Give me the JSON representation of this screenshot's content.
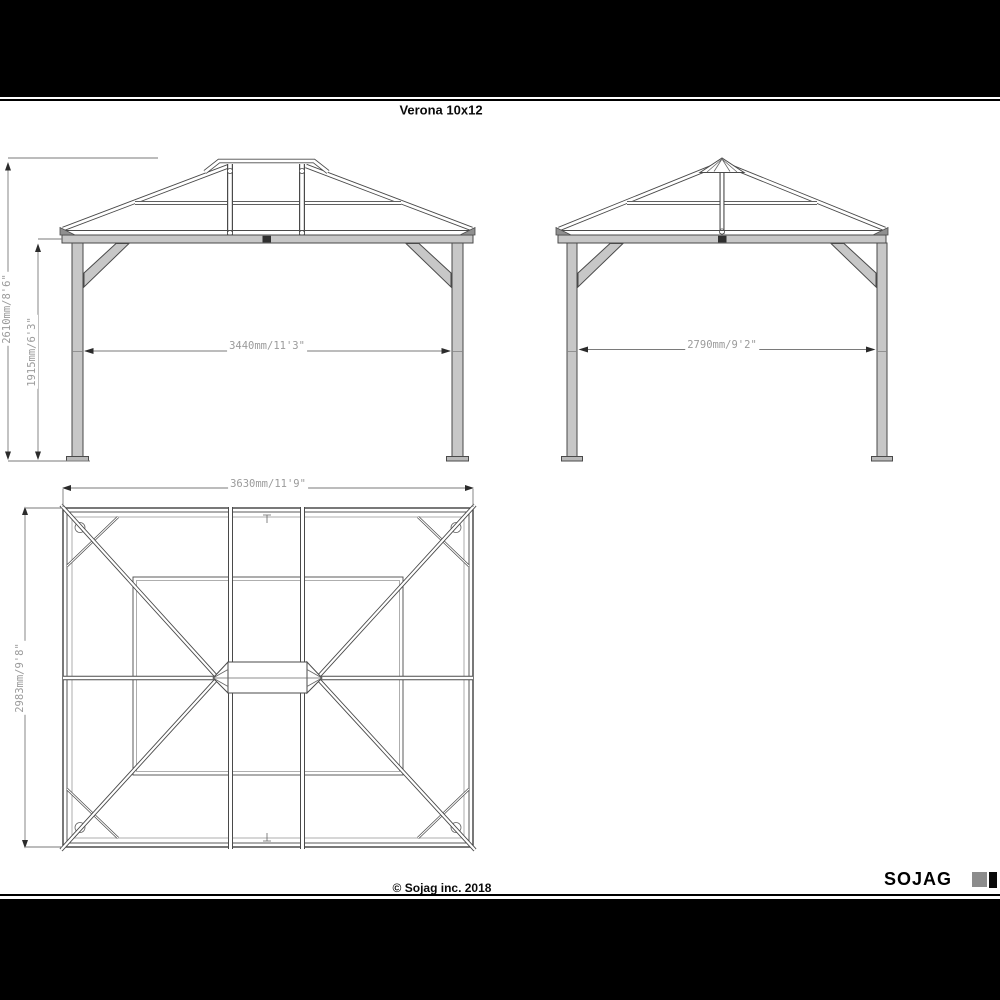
{
  "page": {
    "title": "Verona 10x12"
  },
  "dimensions": {
    "front_total_height": "2610mm/8'6\"",
    "front_post_height": "1915mm/6'3\"",
    "front_clear_width": "3440mm/11'3\"",
    "side_clear_depth": "2790mm/9'2\"",
    "roof_width": "3630mm/11'9\"",
    "roof_depth": "2983mm/9'8\""
  },
  "footer": {
    "copyright": "© Sojag inc. 2018",
    "brand": "SOJAG"
  },
  "colors": {
    "letterbox": "#000000",
    "drawing_line": "#4a4a4a",
    "structure_fill": "#c7c7c7",
    "dimension_text": "#9b9b9b",
    "brand_square_gray": "#8c8c8c"
  }
}
